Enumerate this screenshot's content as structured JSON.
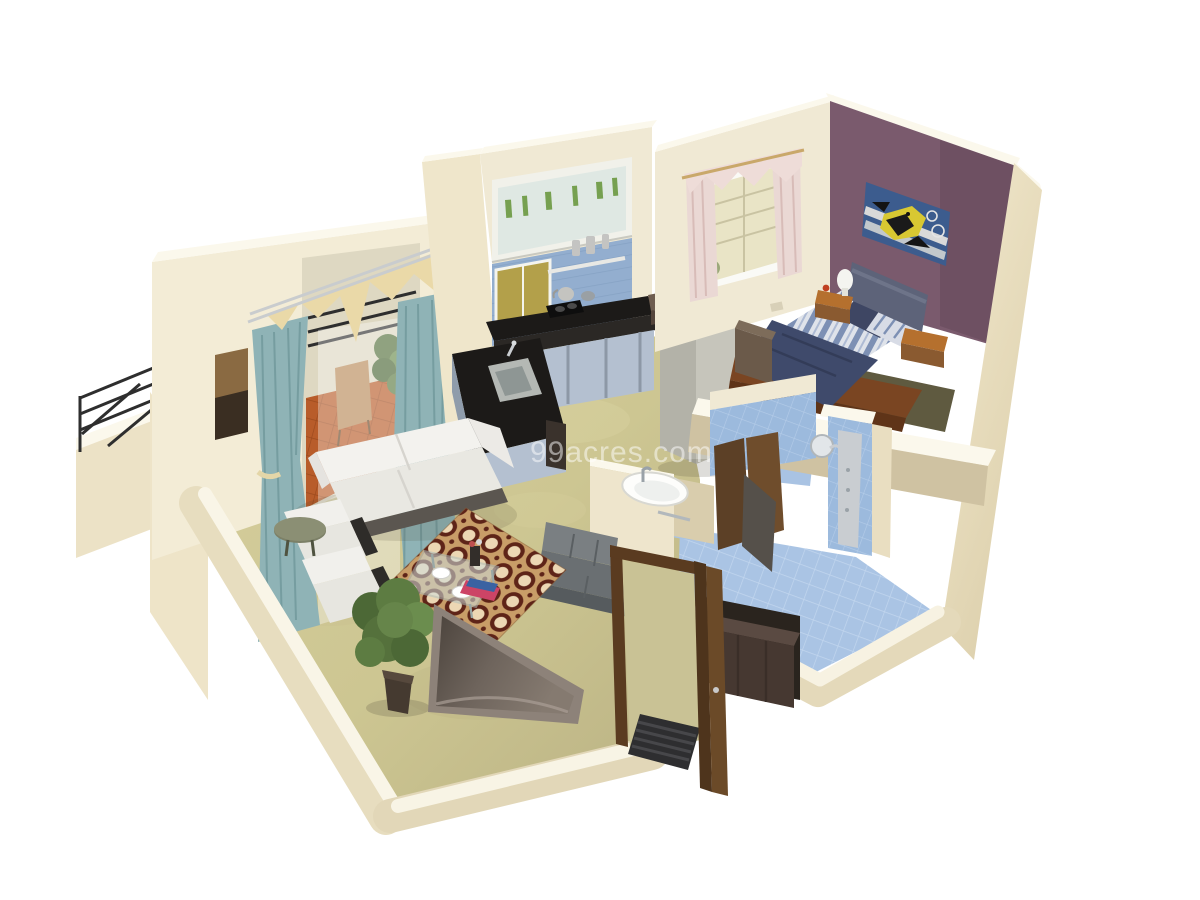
{
  "watermark": {
    "text": "99acres.com",
    "color": "#ffffff",
    "opacity": 0.5
  },
  "palette": {
    "background": "#ffffff",
    "wall_cream": "#efe6cb",
    "wall_top_white": "#fbf8ec",
    "wall_shadow": "#dcd0ae",
    "floor_marble_green": "#cdc692",
    "bedroom_accent_purple": "#7a5a6d",
    "bath_tile_blue": "#a9c3e3",
    "kitchen_backsplash_blue": "#93aecf",
    "kitchen_window_yellow": "#b3a04a",
    "balcony_terracotta": "#b85c2a",
    "curtain_teal": "#8fb3b6",
    "curtain_valance_cream": "#ead9a8",
    "bedroom_curtain_pink": "#ead8d4",
    "rug_base_tan": "#c89d68",
    "rug_ring_maroon": "#5e2418",
    "sofa_white": "#f3f2ee",
    "bench_gray": "#6a6f72",
    "counter_black": "#1c1a18",
    "cabinet_blue_gray": "#b4c0d0",
    "fridge_steel": "#c6c5bb",
    "wood_brown": "#8a5a30",
    "door_brown": "#5a3b20",
    "bed_blanket_navy": "#3f4a6b",
    "bed_stripe_blue": "#7d90b4",
    "painting_bg_blue": "#3c5c8e",
    "painting_fish_yellow": "#d8c832",
    "plant_green": "#5d7c42",
    "tv_panel_gray": "#8d8279"
  },
  "scene": {
    "type": "3d-isometric-floor-plan-render",
    "source_watermark": "99acres.com",
    "rooms": [
      {
        "name": "living-room",
        "objects": [
          "white-sofa",
          "two-white-armchairs",
          "patterned-rug",
          "glass-coffee-table",
          "potted-plant",
          "tv-on-low-wall",
          "olive-side-table",
          "teal-curtains",
          "wall-art"
        ]
      },
      {
        "name": "balcony",
        "objects": [
          "black-metal-railing",
          "terracotta-floor",
          "chair",
          "plant"
        ]
      },
      {
        "name": "kitchen",
        "objects": [
          "blue-backsplash",
          "yellow-window",
          "overhead-glass-cabinet",
          "black-counter",
          "gas-stove",
          "kettle",
          "steel-sink",
          "blue-cabinets",
          "steel-fridge"
        ]
      },
      {
        "name": "bedroom",
        "objects": [
          "purple-accent-wall",
          "fish-painting",
          "double-bed-blue-bedding",
          "headboard",
          "nightstands",
          "white-lamp",
          "pink-floral-window-curtains",
          "wood-chest"
        ]
      },
      {
        "name": "bathroom",
        "objects": [
          "blue-tiled-floor",
          "blue-tiled-walls",
          "shower-panel",
          "round-shower-head",
          "brown-doors"
        ]
      },
      {
        "name": "hallway-entrance",
        "objects": [
          "white-washbasin",
          "gray-bench",
          "open-brown-entry-door",
          "striped-doormat",
          "dark-shoe-cabinet"
        ]
      }
    ]
  }
}
